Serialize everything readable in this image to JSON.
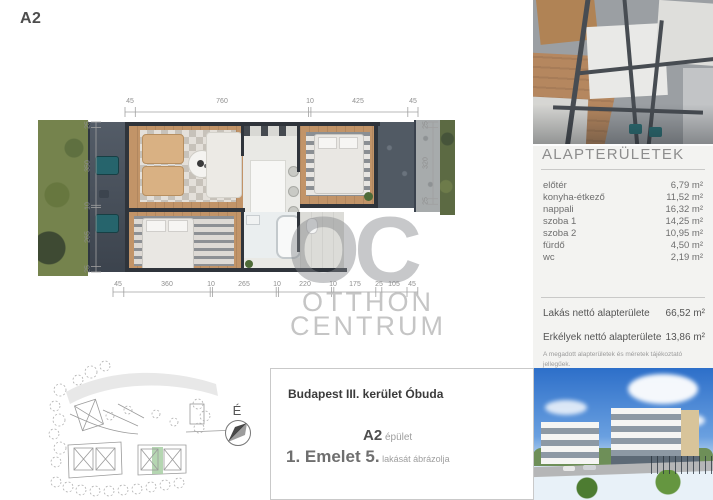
{
  "page": {
    "unit_label": "A2"
  },
  "floorplan": {
    "dims_top": [
      "45",
      "760",
      "10",
      "425",
      "45"
    ],
    "dims_bottom": [
      "45",
      "360",
      "10",
      "265",
      "10",
      "220",
      "10",
      "175",
      "25",
      "105",
      "45"
    ],
    "dims_left": [
      "25",
      "350",
      "10",
      "265",
      "25"
    ],
    "dims_right": [
      "25",
      "320",
      "25"
    ]
  },
  "watermark": {
    "initials": "OC",
    "line1": "OTTHON",
    "line2": "CENTRUM"
  },
  "compass": {
    "label": "É"
  },
  "info_box": {
    "address": "Budapest III. kerület Óbuda",
    "building_bold": "A2",
    "building_suffix": " épület",
    "floor_bold": "1. Emelet 5.",
    "floor_suffix": " lakását ábrázolja"
  },
  "sidebar": {
    "title": "ALAPTERÜLETEK",
    "rooms": [
      {
        "label": "előtér",
        "value": "6,79 m²"
      },
      {
        "label": "konyha-étkező",
        "value": "11,52 m²"
      },
      {
        "label": "nappali",
        "value": "16,32 m²"
      },
      {
        "label": "szoba 1",
        "value": "14,25 m²"
      },
      {
        "label": "szoba 2",
        "value": "10,95 m²"
      },
      {
        "label": "fürdő",
        "value": "4,50 m²"
      },
      {
        "label": "wc",
        "value": "2,19 m²"
      }
    ],
    "totals": [
      {
        "label": "Lakás nettó alapterülete",
        "value": "66,52 m²"
      },
      {
        "label": "Erkélyek nettó alapterülete",
        "value": "13,86 m²"
      }
    ],
    "note_line1": "A megadott alapterületek és méretek tájékoztató jellegűek.",
    "note_line2": "Az ábrázolt berendezés illusztráció.",
    "colors": {
      "highlight_green": "#a8cfa4",
      "watermark_gray": "#c5c5c5"
    }
  }
}
